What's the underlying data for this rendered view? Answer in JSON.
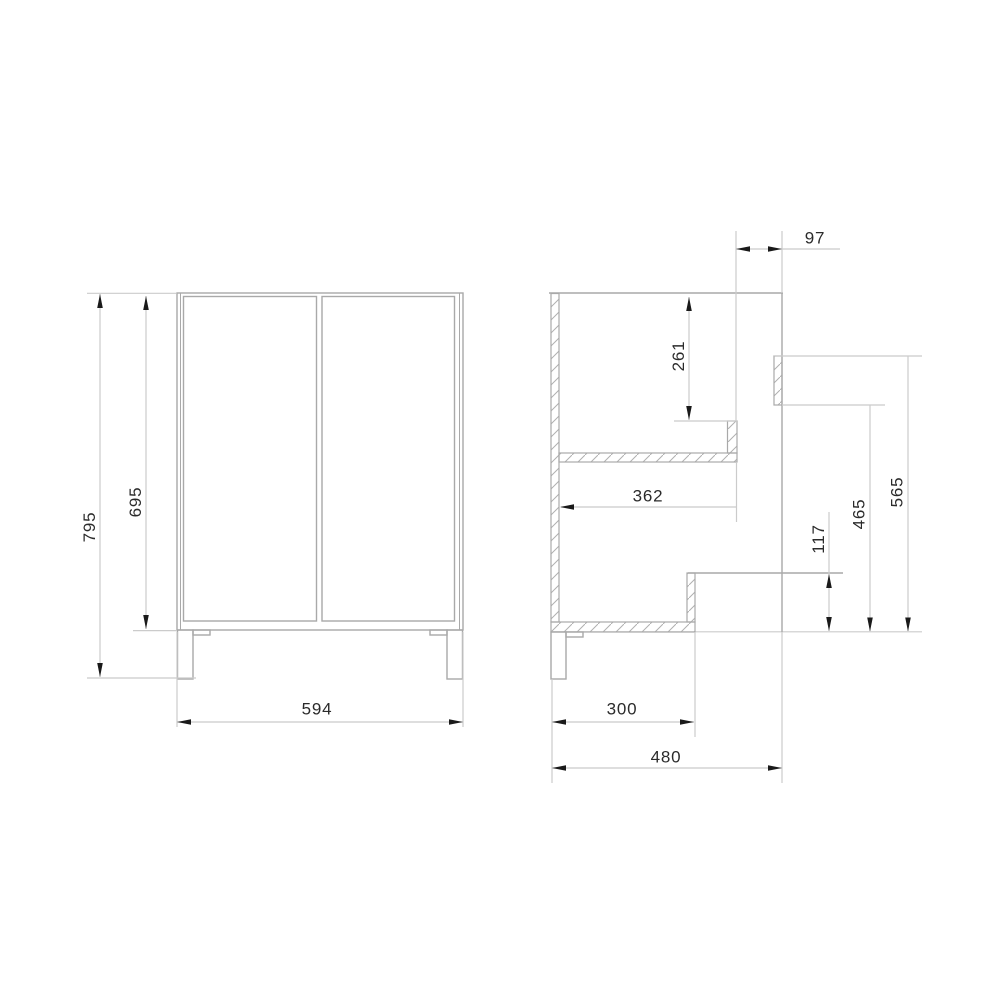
{
  "drawing_title": "cabinet-dimension-drawing",
  "colors": {
    "object_line": "#a9a9a9",
    "thin_line": "#cbcbcb",
    "hatch_line": "#b0b0b0",
    "arrow": "#1a1a1a",
    "text": "#2b2b2b",
    "background": "#ffffff"
  },
  "views": {
    "front": {
      "name": "front-view",
      "dims": {
        "overall_height": "795",
        "body_height": "695",
        "width": "594"
      }
    },
    "side": {
      "name": "side-section-view",
      "dims": {
        "top_inset": "97",
        "upper_depth": "261",
        "shelf_depth": "362",
        "height_to_rail_top": "565",
        "height_to_rail_bottom": "465",
        "front_recess_height": "117",
        "bottom_depth": "300",
        "overall_depth": "480"
      }
    }
  }
}
